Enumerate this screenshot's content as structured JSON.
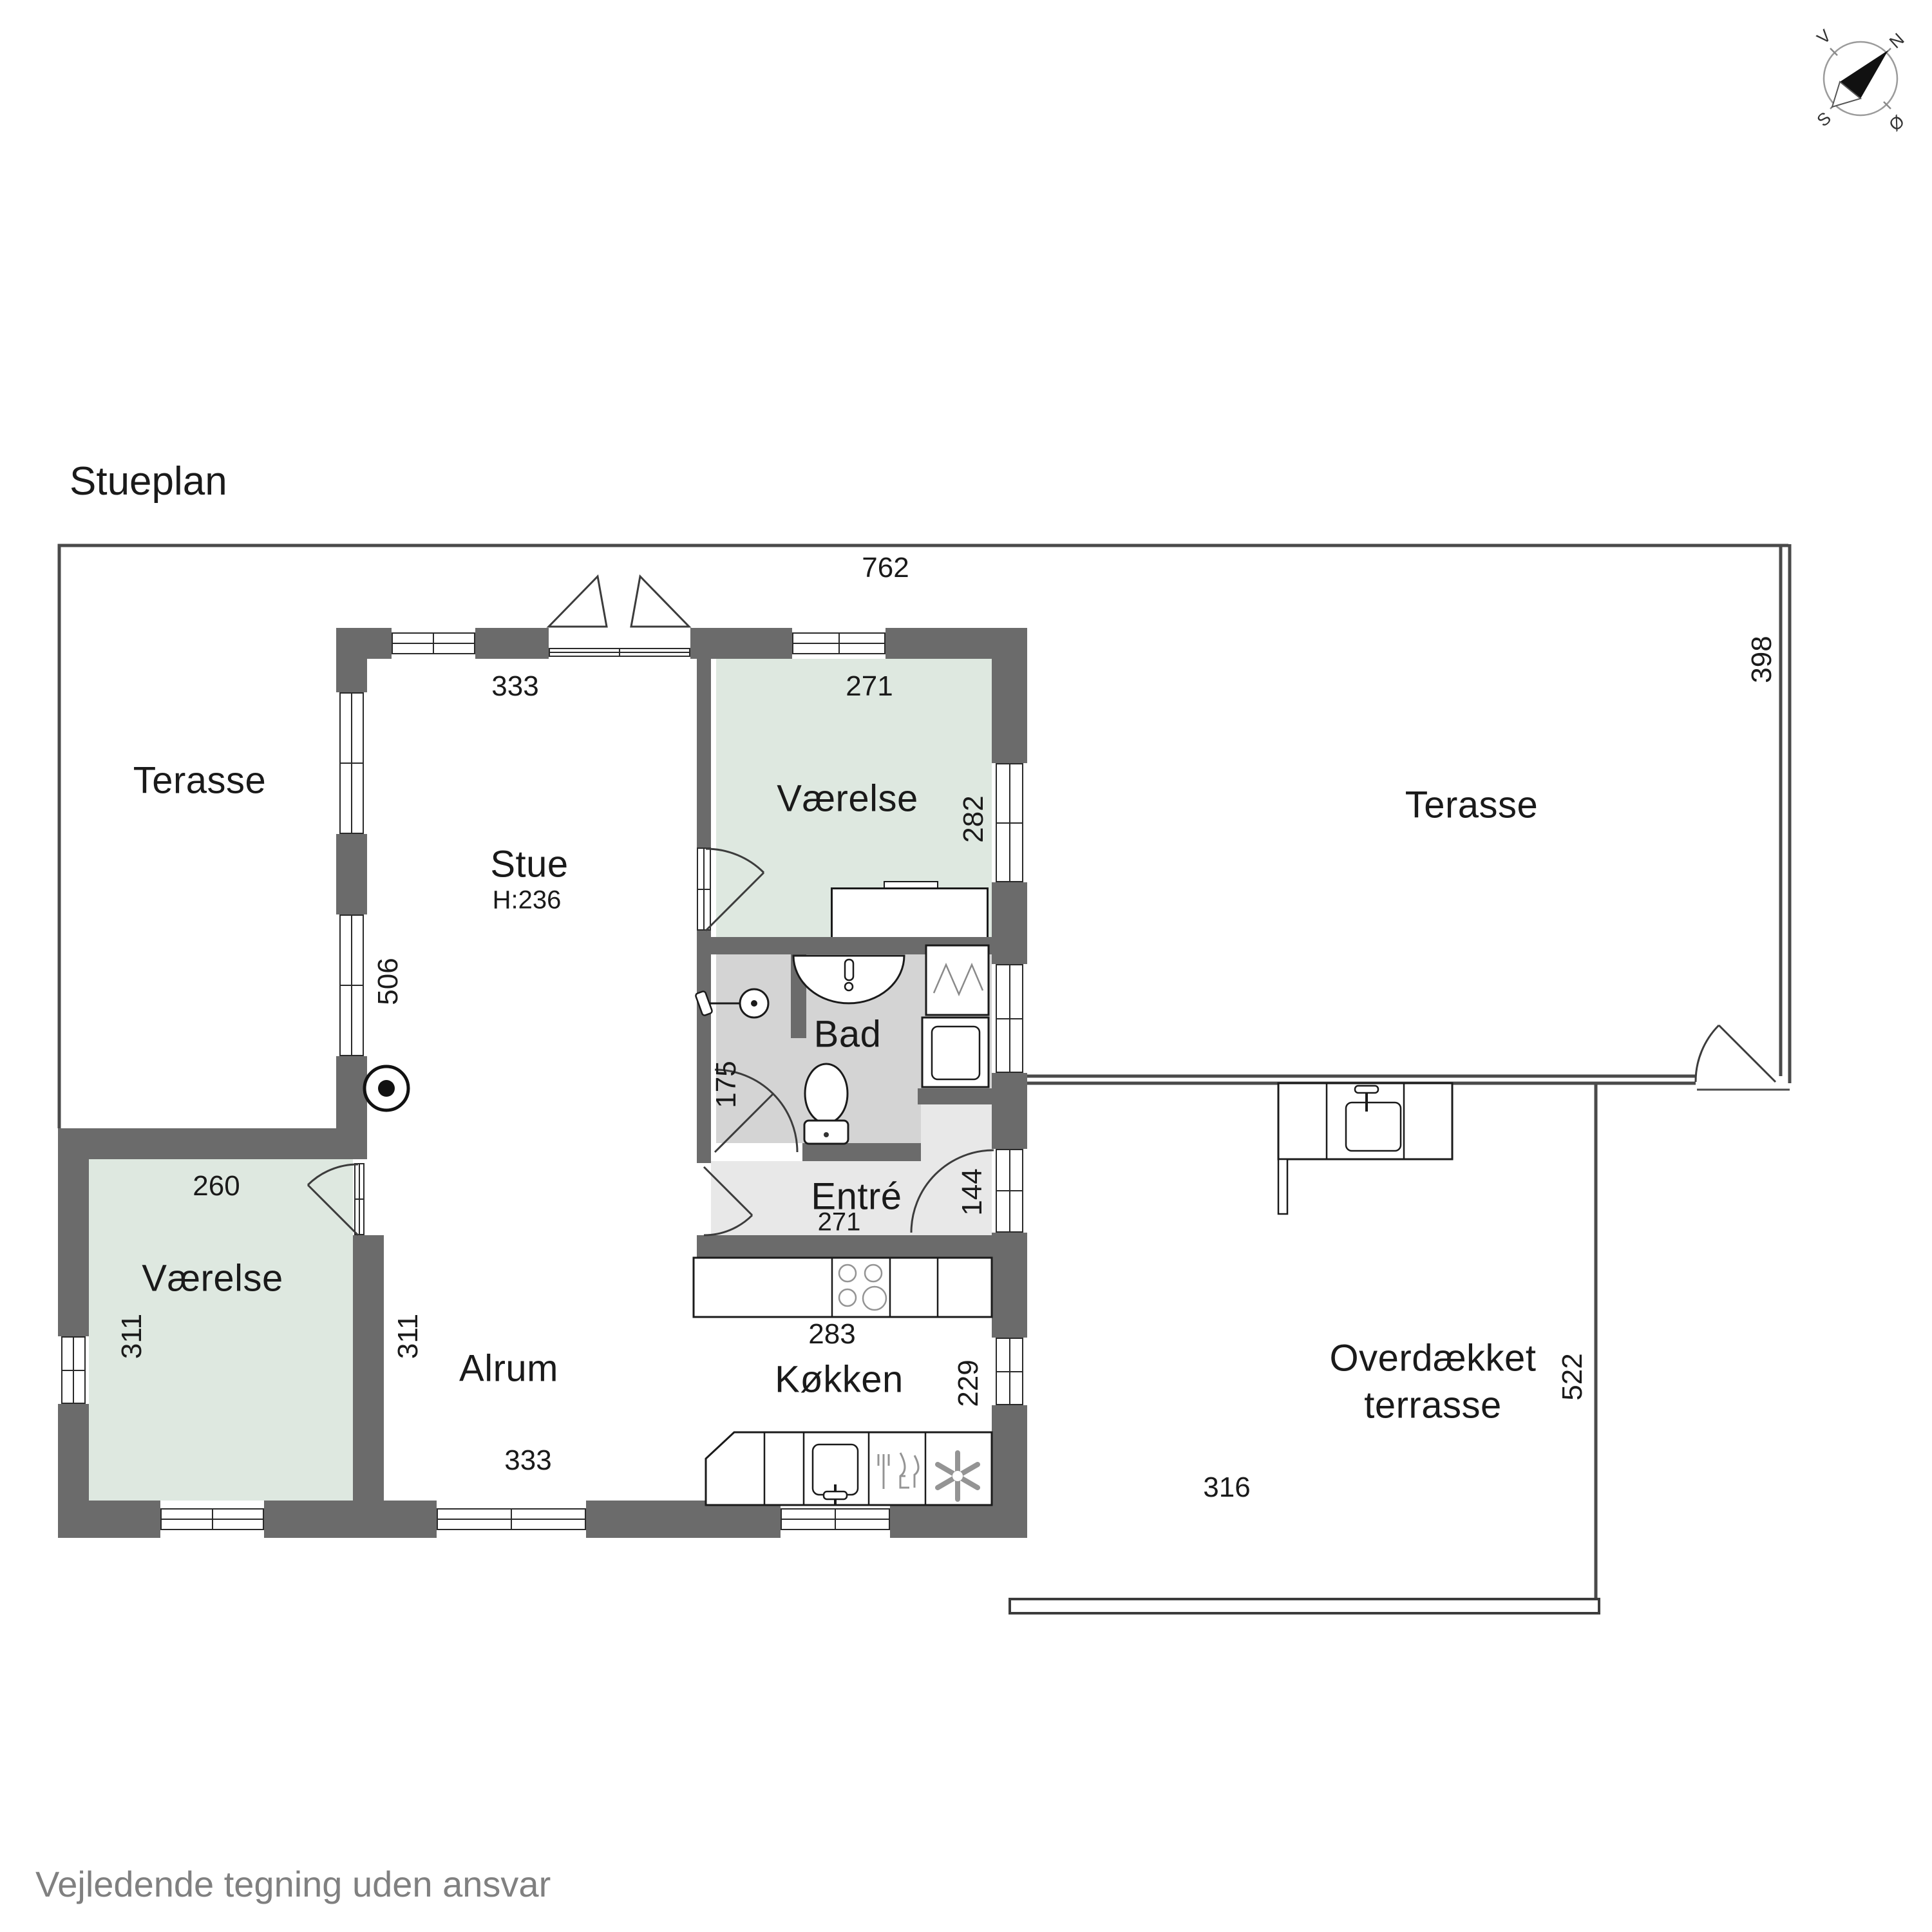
{
  "title": "Stueplan",
  "footer": "Vejledende tegning uden ansvar",
  "compass": {
    "north": "N",
    "south": "S",
    "east": "Ø",
    "west": "V"
  },
  "rooms": {
    "terrace_left": {
      "label": "Terasse"
    },
    "stue": {
      "label": "Stue",
      "ceiling_height": "H:236"
    },
    "vaerelse_top": {
      "label": "Værelse"
    },
    "bad": {
      "label": "Bad"
    },
    "entre": {
      "label": "Entré"
    },
    "koekken": {
      "label": "Køkken"
    },
    "alrum": {
      "label": "Alrum"
    },
    "vaerelse_bottom": {
      "label": "Værelse"
    },
    "terrace_right": {
      "label": "Terasse"
    },
    "overdaekket": {
      "label": "Overdækket terrasse"
    }
  },
  "dimensions": {
    "outer_top": "762",
    "stue_top": "333",
    "vaerelse_top_width": "271",
    "vaerelse_top_height": "282",
    "terrace_right_height": "398",
    "stue_left_height": "506",
    "bad_height": "175",
    "entre_door_width": "144",
    "vaerelse_bottom_width": "260",
    "vaerelse_bottom_height_inner": "311",
    "vaerelse_bottom_height_outer": "311",
    "entre_bottom_width": "271",
    "kitchen_island_width": "283",
    "koekken_right_height": "229",
    "alrum_bottom_width": "333",
    "overdaekket_bottom_width": "316",
    "overdaekket_right_height": "522"
  },
  "icons": [
    "compass-rose-icon",
    "wood-stove-icon",
    "bathroom-sink-icon",
    "toilet-icon",
    "shower-icon",
    "shower-cabin-icon",
    "washer-icon",
    "hob-icon",
    "kitchen-sink-icon",
    "dishwasher-icon",
    "fan-icon",
    "outdoor-sink-icon"
  ],
  "colors": {
    "wall": "#6b6b6b",
    "line": "#3c3c3c",
    "room_green": "#dee8e0",
    "bad_gray": "#d4d4d4",
    "entre_gray": "#e8e8e8",
    "text": "#1a1a1a",
    "muted": "#808080",
    "fixture": "#949494"
  }
}
